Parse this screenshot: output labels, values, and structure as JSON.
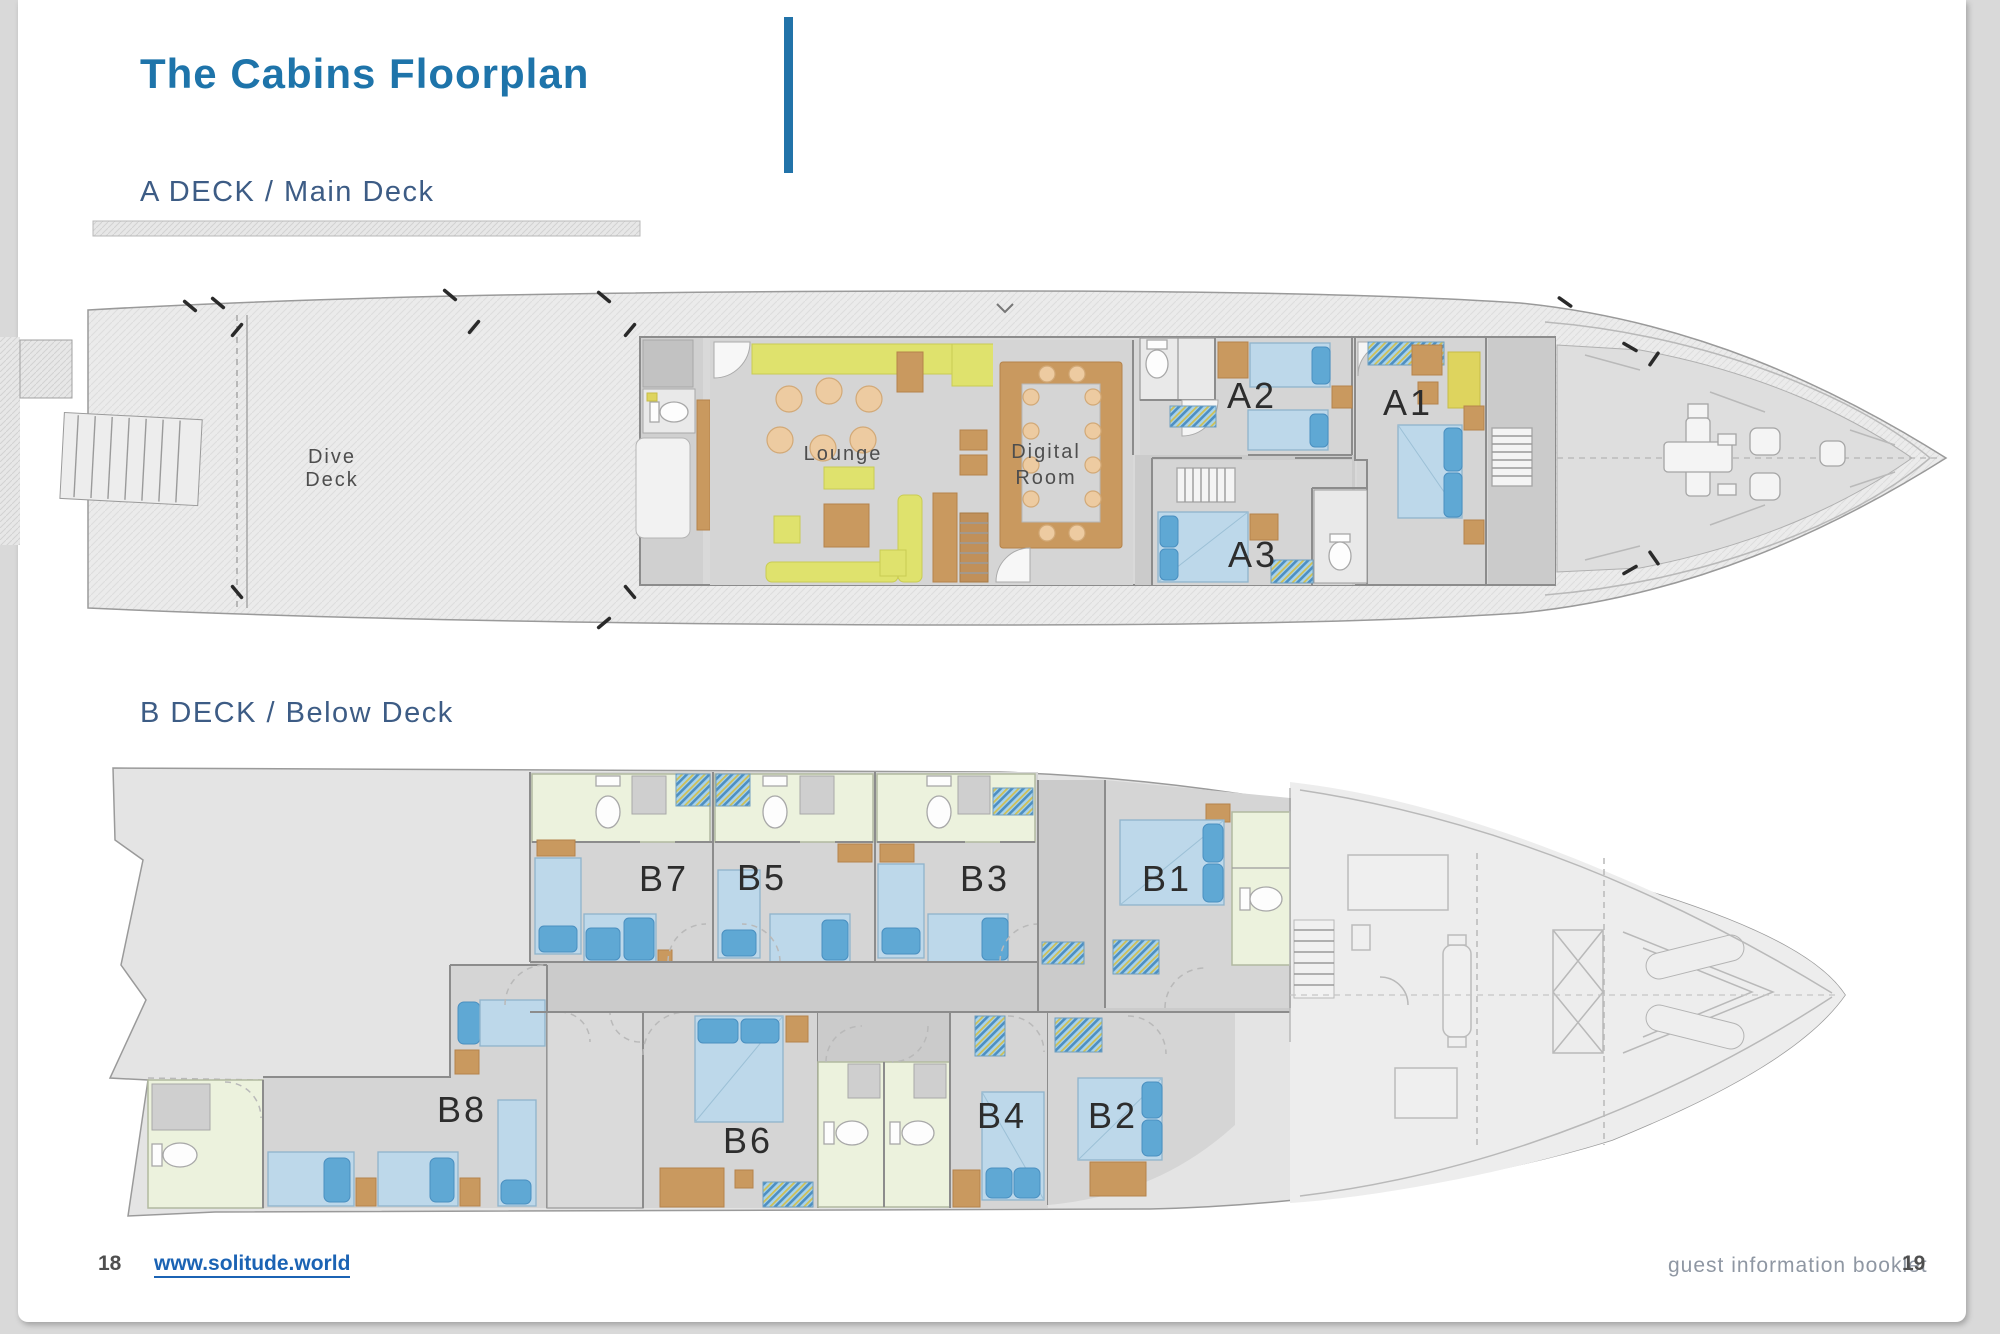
{
  "page": {
    "title": "The Cabins Floorplan",
    "deck_a_heading": "A DECK / Main Deck",
    "deck_b_heading": "B DECK / Below Deck"
  },
  "deck_a": {
    "labels": {
      "dive_line1": "Dive",
      "dive_line2": "Deck",
      "lounge": "Lounge",
      "digital_line1": "Digital",
      "digital_line2": "Room",
      "cabin_a1": "A1",
      "cabin_a2": "A2",
      "cabin_a3": "A3"
    }
  },
  "deck_b": {
    "labels": {
      "cabin_b1": "B1",
      "cabin_b2": "B2",
      "cabin_b3": "B3",
      "cabin_b4": "B4",
      "cabin_b5": "B5",
      "cabin_b6": "B6",
      "cabin_b7": "B7",
      "cabin_b8": "B8"
    }
  },
  "footer": {
    "page_number_left": "18",
    "website_link": "www.solitude.world",
    "booklet_label": "guest information booklet",
    "page_number_right": "19"
  },
  "colors": {
    "title_blue": "#1e74aa",
    "section_blue": "#3d5c85",
    "divider_bar_blue": "#2273a9",
    "link_blue": "#1b63b4",
    "bed_blue": "#bdd8ea",
    "pillow_blue": "#5fa8d4",
    "bathroom_green": "#ecf2dd",
    "furniture_tan": "#c9995f",
    "sofa_yellow": "#dfe26d",
    "floor_gray": "#d5d5d5",
    "hull_gray": "#e9e9e9"
  }
}
